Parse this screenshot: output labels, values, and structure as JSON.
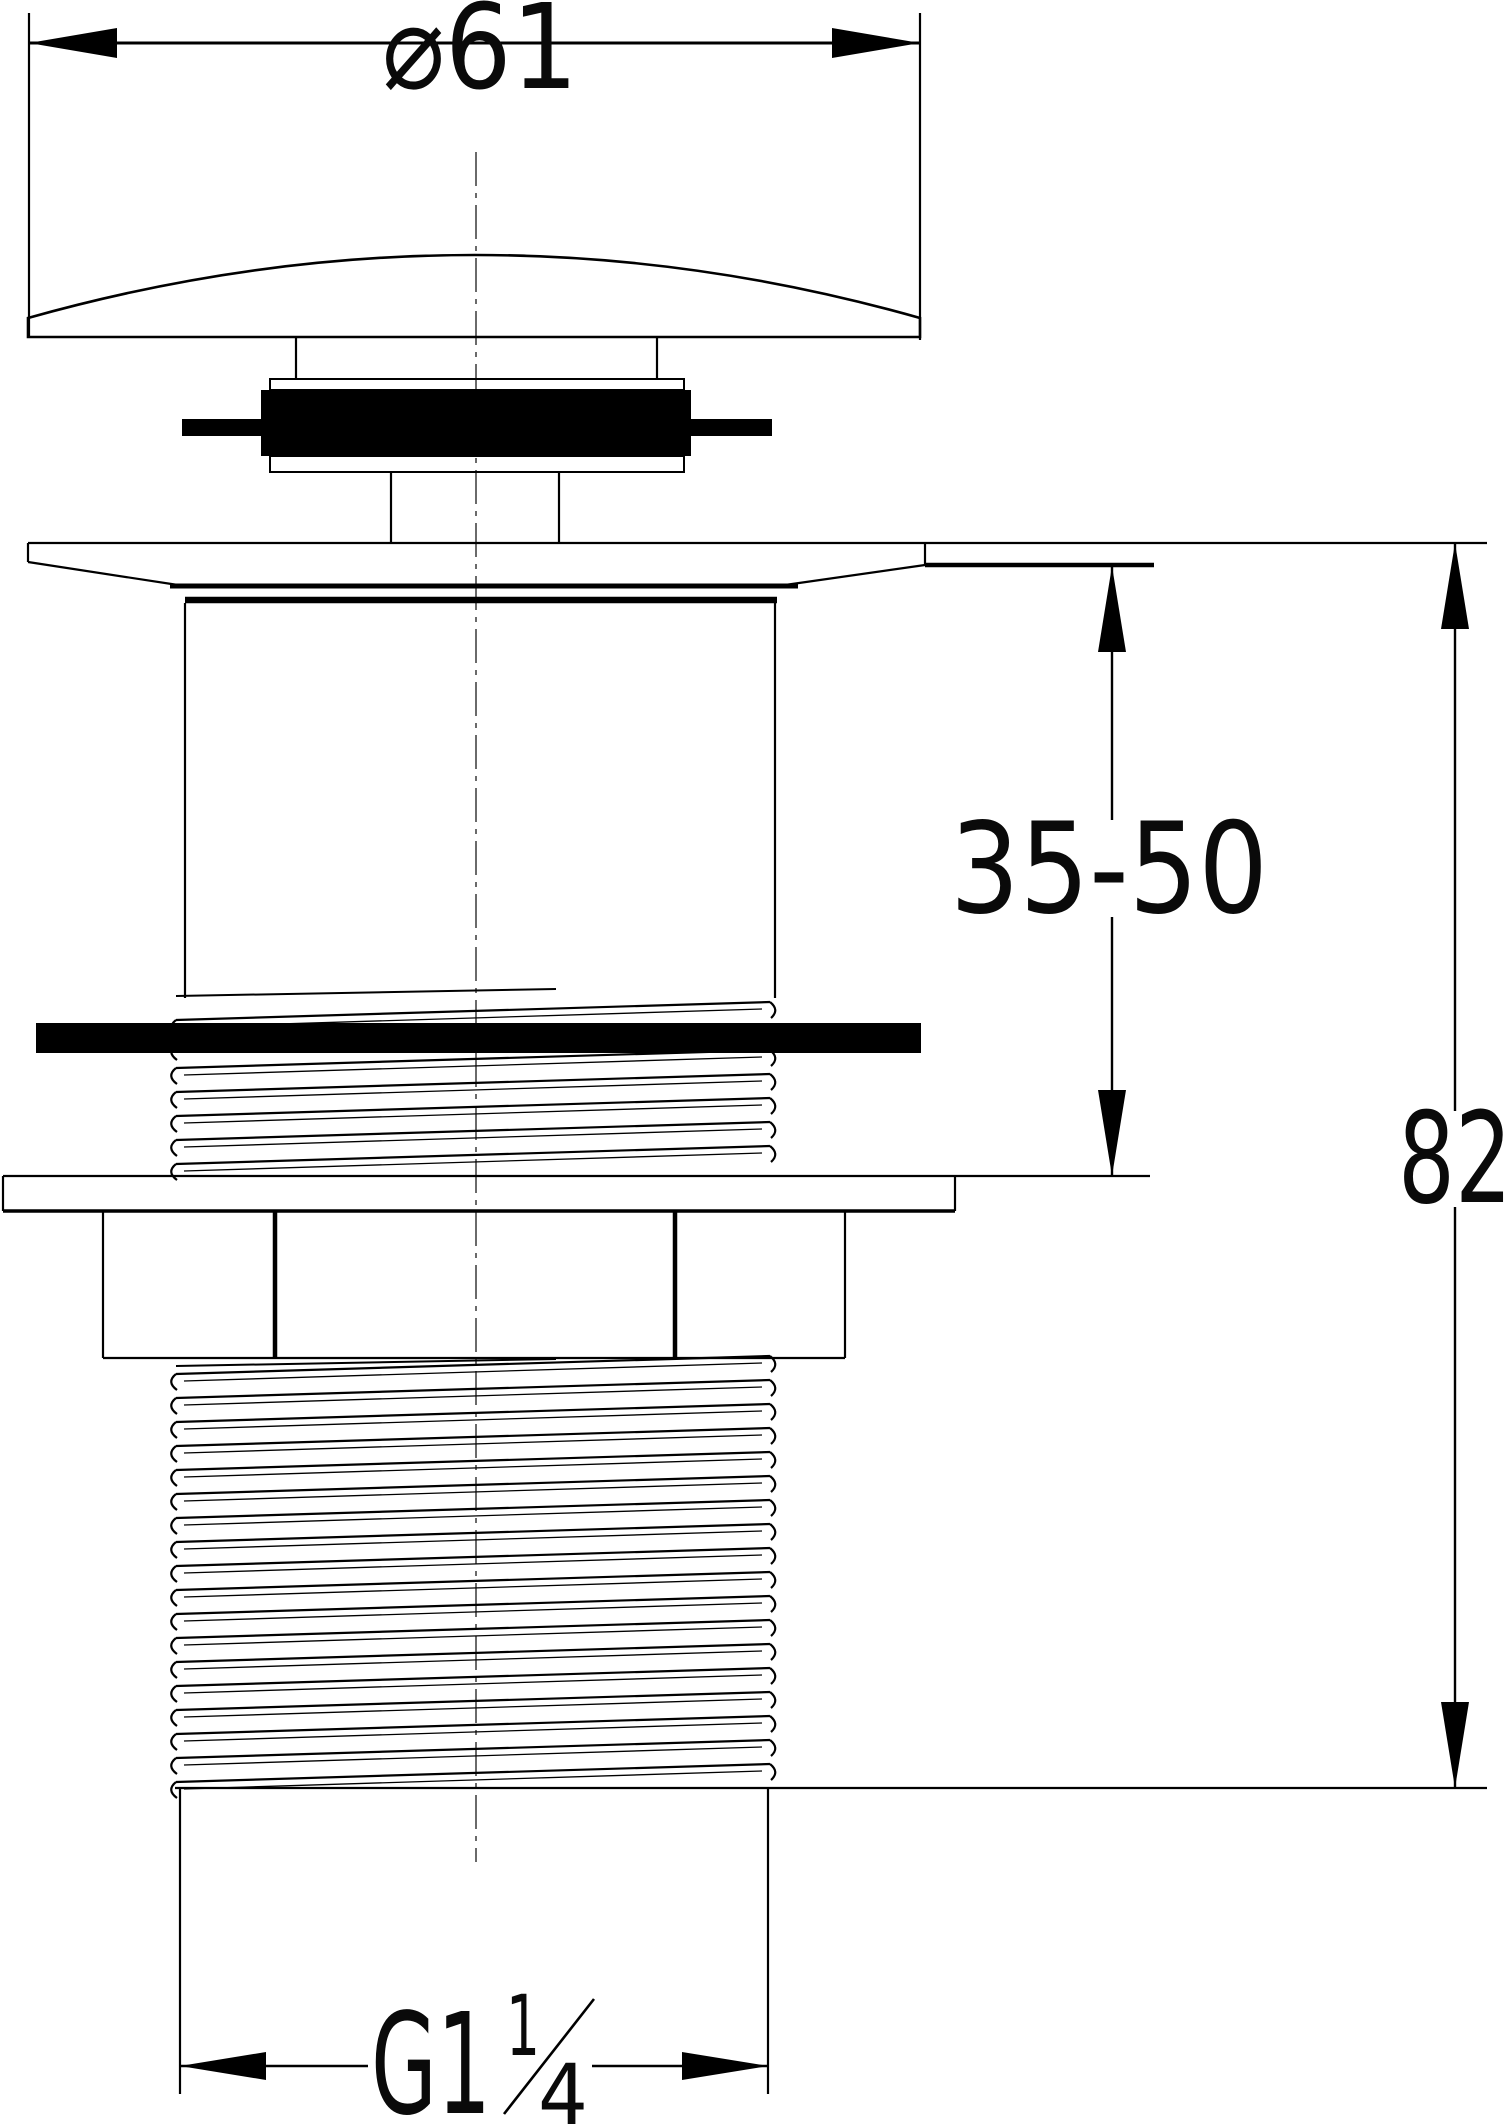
{
  "drawing": {
    "background_color": "#ffffff",
    "line_color": "#000000",
    "seal_color": "#000000",
    "dimensions": {
      "diameter": {
        "label": "⌀61"
      },
      "clamp_range": {
        "label": "35-50"
      },
      "overall_height": {
        "label": "82"
      },
      "thread": {
        "prefix": "G1",
        "numerator": "1",
        "denominator": "4"
      }
    }
  }
}
